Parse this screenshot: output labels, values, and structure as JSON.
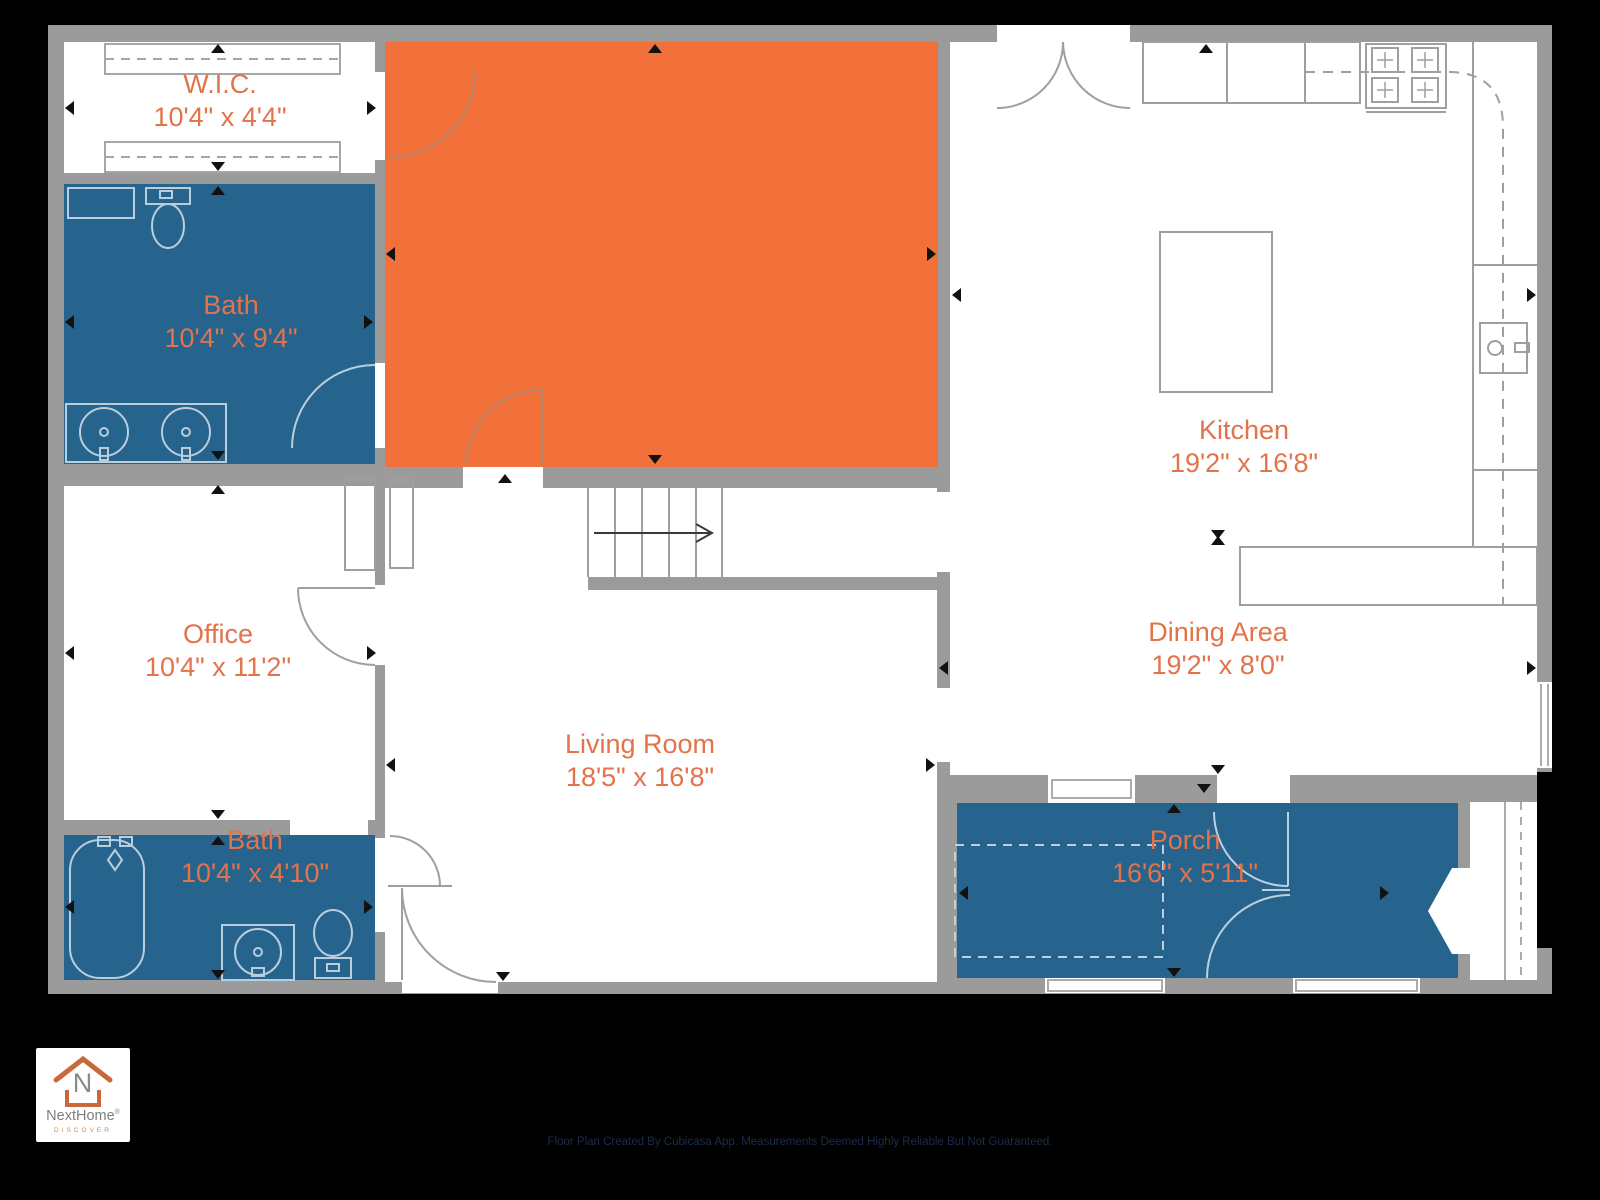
{
  "page": {
    "background_color": "#000000"
  },
  "plan": {
    "colors": {
      "wall": "#9b9b9b",
      "floor": "#ffffff",
      "wet_room_fill": "#26648e",
      "highlighted_room_fill": "#f2703a",
      "label_text": "#e2734a",
      "dimension_arrow": "#111111"
    },
    "rooms": [
      {
        "name": "W.I.C.",
        "dims": "10'4\" x 4'4\""
      },
      {
        "name": "Bath",
        "dims": "10'4\" x 9'4\""
      },
      {
        "name": "Kitchen",
        "dims": "19'2\" x 16'8\""
      },
      {
        "name": "Office",
        "dims": "10'4\" x 11'2\""
      },
      {
        "name": "Dining Area",
        "dims": "19'2\" x 8'0\""
      },
      {
        "name": "Living Room",
        "dims": "18'5\" x 16'8\""
      },
      {
        "name": "Bath",
        "dims": "10'4\" x 4'10\""
      },
      {
        "name": "Porch",
        "dims": "16'6\" x 5'11\""
      }
    ]
  },
  "branding": {
    "logo_letter": "N",
    "logo_name": "NextHome",
    "logo_trademark": "®",
    "logo_tagline": "DISCOVER"
  },
  "footer": {
    "disclaimer": "Floor Plan Created By Cubicasa App. Measurements Deemed Highly Reliable But Not Guaranteed."
  }
}
